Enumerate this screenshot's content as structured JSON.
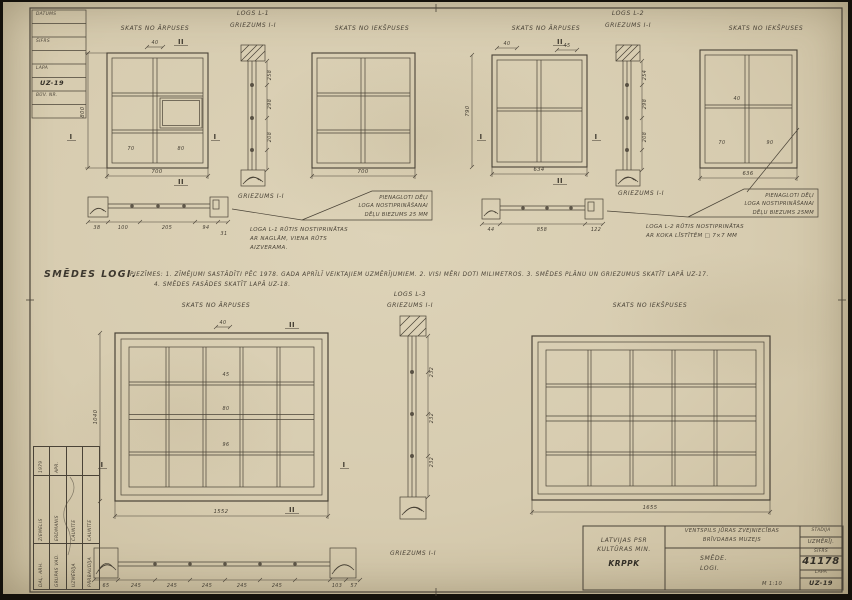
{
  "colors": {
    "paper": "#d8cdb2",
    "ink": "#4a4337",
    "pencil": "#35302a"
  },
  "corner_table": {
    "rows": [
      "DATUMS",
      "",
      "ŠIFRS",
      "",
      "LAPA",
      "UZ-19",
      "BŪV. NR.",
      ""
    ]
  },
  "notes": {
    "title": "SMĒDES LOGI.",
    "line1": "PIEZĪMES:   1. ZĪMĒJUMI SASTĀDĪTI PĒC 1978. GADA APRĪLĪ VEIKTAJIEM UZMĒRĪJUMIEM.   2. VISI MĒRI DOTI MILIMETROS.   3. SMĒDES PLĀNU UN GRIEZUMUS SKATĪT LAPĀ UZ-17.",
    "line2": "4. SMĒDES FASĀDES SKATĪT LAPĀ UZ-18."
  },
  "marks": {
    "i": "I",
    "ii": "II"
  },
  "groups": {
    "l1": {
      "title": "LOGS L-1",
      "section": "GRIEZUMS I-I",
      "ext": "SKATS NO ĀRPUSES",
      "int": "SKATS NO IEKŠPUSES",
      "sill_section": "GRIEZUMS I-I",
      "note_box": [
        "PIENAGLOTI DĒĻI",
        "LOGA NOSTIPRINĀŠANAI",
        "DĒĻU BIEZUMS 25 MM"
      ],
      "note": [
        "LOGA L-1 RŪTIS NOSTIPRINĀTAS",
        "AR NAGLĀM, VIENA RŪTS",
        "AIZVERAMA."
      ],
      "dims": {
        "height": "800",
        "ext_width": "700",
        "int_width": "700",
        "top": "40",
        "pane_a": "70",
        "pane_b": "80",
        "strip": [
          "258",
          "298",
          "208"
        ],
        "sill": [
          "38",
          "100",
          "205",
          "94",
          "31"
        ]
      }
    },
    "l2": {
      "title": "LOGS L-2",
      "section": "GRIEZUMS I-I",
      "ext": "SKATS NO ĀRPUSES",
      "int": "SKATS NO IEKŠPUSES",
      "sill_section": "GRIEZUMS I-I",
      "note_box": [
        "PIENAGLOTI DĒĻI",
        "LOGA NOSTIPRINĀŠANAI",
        "DĒĻU BIEZUMS 25MM"
      ],
      "note": [
        "LOGA L-2 RŪTIS NOSTIPRINĀTAS",
        "AR KOKA LĪSTĪTĒM □ 7×7 MM"
      ],
      "dims": {
        "height": "790",
        "ext_width": "634",
        "int_width": "636",
        "top_a": "40",
        "top_b": "45",
        "pane_a": "70",
        "pane_b": "90",
        "pane_c": "40",
        "strip": [
          "254",
          "298",
          "208"
        ],
        "sill": [
          "44",
          "858",
          "122"
        ]
      }
    },
    "l3": {
      "title": "LOGS L-3",
      "section": "GRIEZUMS I-I",
      "ext": "SKATS NO ĀRPUSES",
      "int": "SKATS NO IEKŠPUSES",
      "sill_section": "GRIEZUMS I-I",
      "dims": {
        "ext_width": "1552",
        "ext_height": "1040",
        "int_width": "1655",
        "top": "40",
        "mid": [
          "45",
          "80",
          "96"
        ],
        "strip": [
          "232",
          "232",
          "232"
        ],
        "sill": [
          "65",
          "245",
          "245",
          "245",
          "245",
          "245",
          "103",
          "57"
        ]
      }
    }
  },
  "title_block": {
    "org_line1": "LATVIJAS PSR",
    "org_line2": "KULTŪRAS MIN.",
    "org_line3": "KRPPK",
    "project_line1": "VENTSPILS JŪRAS ZVEJNIECĪBAS",
    "project_line2": "BRĪVDABAS MUZEJS",
    "stadija_label": "STADIJA",
    "stadija_value": "UZMĒRĪJ.",
    "sheet_line1": "SMĒDE.",
    "sheet_line2": "LOGI.",
    "sifrs_label": "ŠIFRS",
    "sifrs_value": "41178",
    "scale": "M 1:10",
    "lapa_label": "LAPA",
    "lapa_value": "UZ-19"
  },
  "sig_table": {
    "rows": [
      {
        "role": "DAĻ. ARH.",
        "name": "ZIEMELIS",
        "date": "1979"
      },
      {
        "role": "GRUPAS VAD.",
        "name": "ERDMANIS",
        "date": "APR."
      },
      {
        "role": "UZMĒRĪJA",
        "name": "CAUNĪTE",
        "date": ""
      },
      {
        "role": "PĀRBAUDĪJA",
        "name": "CAUNĪTE",
        "date": ""
      }
    ]
  }
}
